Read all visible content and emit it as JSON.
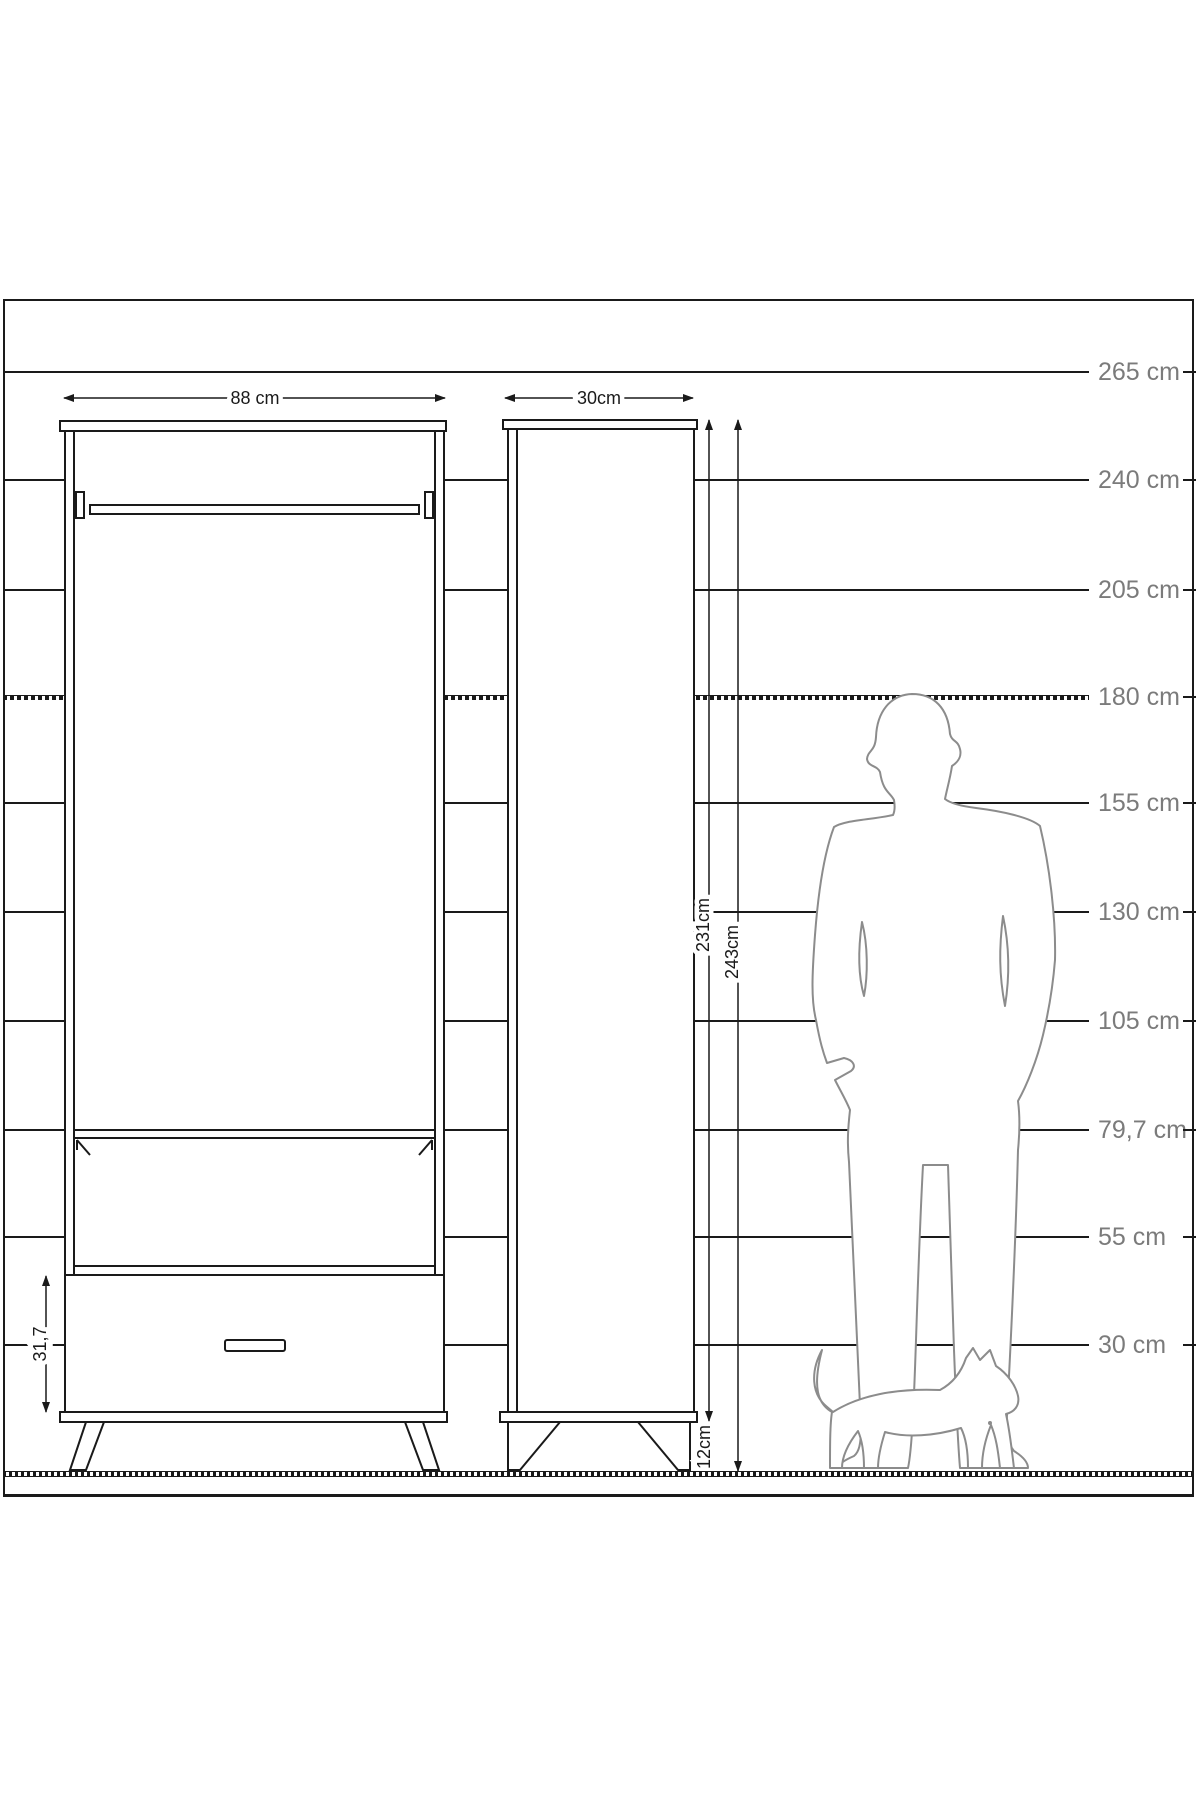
{
  "diagram_title": "wardrobe-dimension-diagram",
  "scale": {
    "label_color": "#7b7b7b",
    "lines": [
      {
        "label": "265 cm",
        "y": 372,
        "hatched": false
      },
      {
        "label": "240 cm",
        "y": 480,
        "hatched": false
      },
      {
        "label": "205 cm",
        "y": 590,
        "hatched": false
      },
      {
        "label": "180 cm",
        "y": 697,
        "hatched": true
      },
      {
        "label": "155 cm",
        "y": 803,
        "hatched": false
      },
      {
        "label": "130 cm",
        "y": 912,
        "hatched": false
      },
      {
        "label": "105 cm",
        "y": 1021,
        "hatched": false
      },
      {
        "label": "79,7 cm",
        "y": 1130,
        "hatched": false
      },
      {
        "label": "55 cm",
        "y": 1237,
        "hatched": false
      },
      {
        "label": "30 cm",
        "y": 1345,
        "hatched": false
      }
    ],
    "floor_y": 1471
  },
  "dimensions": {
    "front_width": "88 cm",
    "side_depth": "30cm",
    "body_height": "231cm",
    "total_height": "243cm",
    "leg_height": "12cm",
    "drawer_height": "31,7"
  },
  "colors": {
    "line": "#1a1a1a",
    "silhouette": "#8c8c8c",
    "scale_label": "#7b7b7b"
  }
}
